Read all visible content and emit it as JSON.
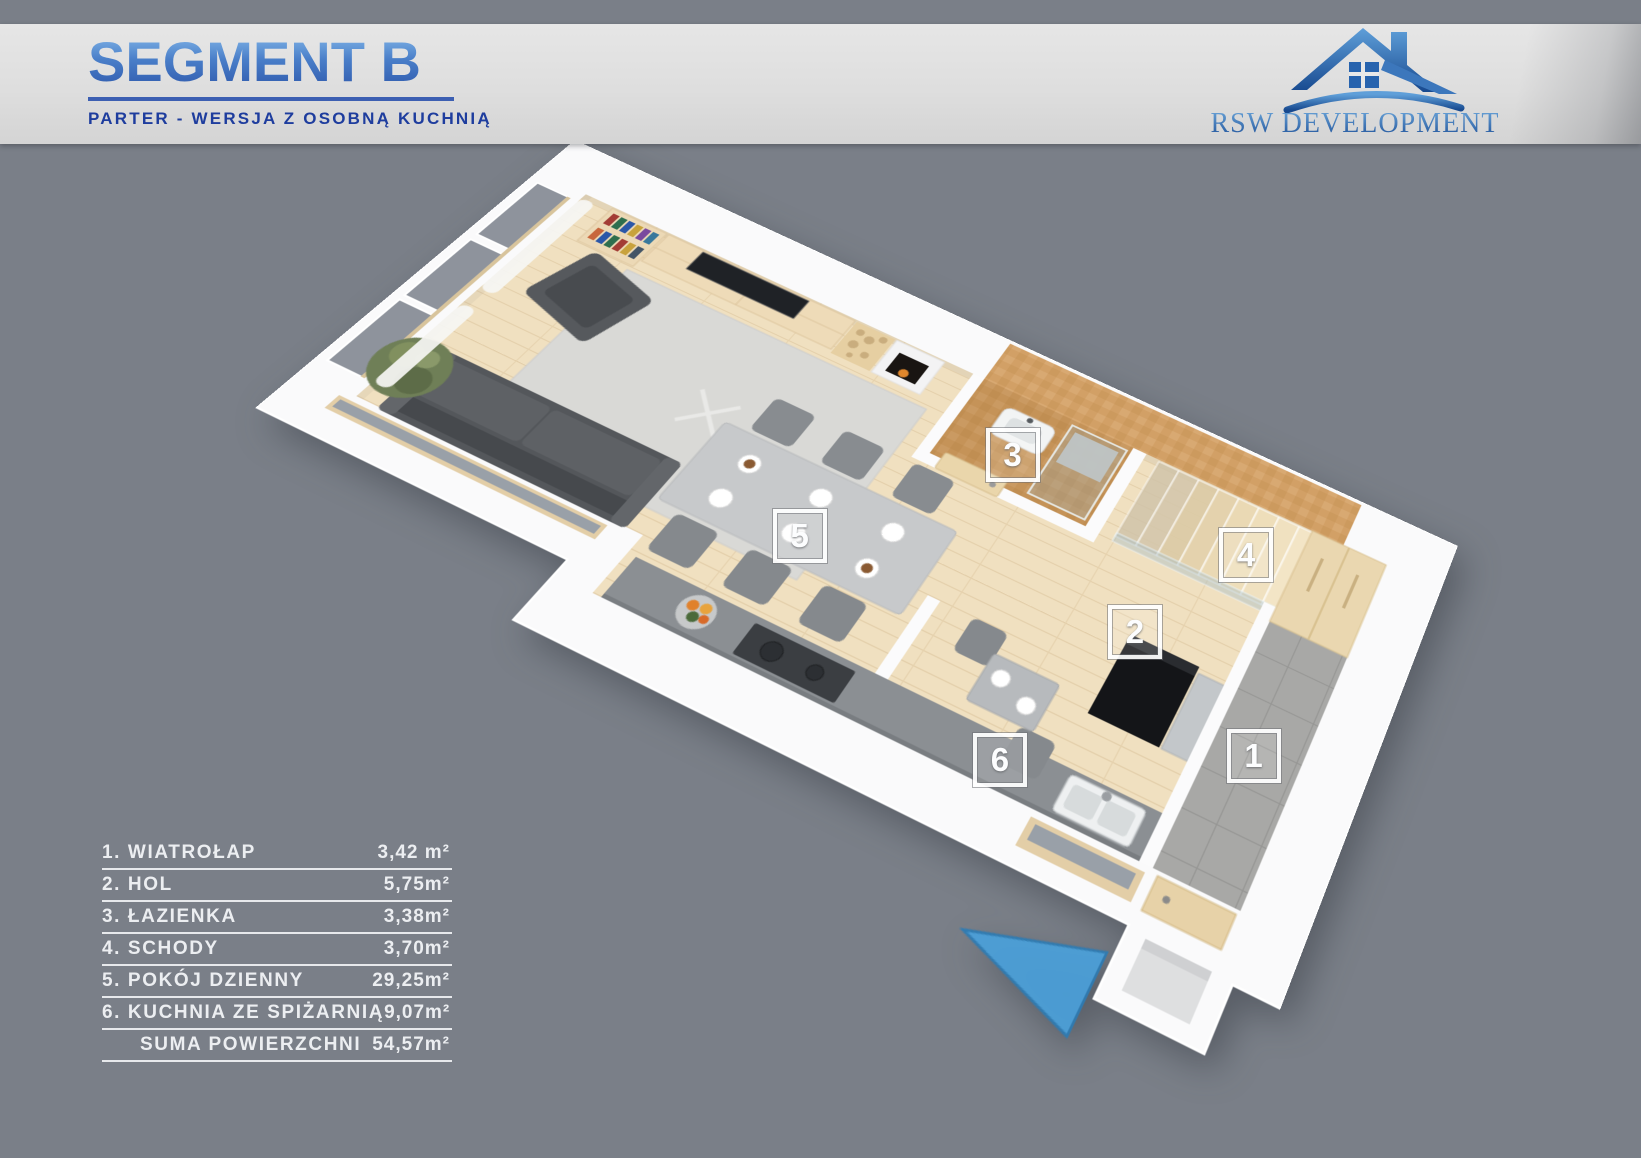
{
  "header": {
    "title": "SEGMENT B",
    "subtitle": "PARTER - WERSJA Z OSOBNĄ KUCHNIĄ"
  },
  "logo": {
    "name": "RSW DEVELOPMENT"
  },
  "plan": {
    "markers": [
      {
        "number": "1"
      },
      {
        "number": "2"
      },
      {
        "number": "3"
      },
      {
        "number": "4"
      },
      {
        "number": "5"
      },
      {
        "number": "6"
      }
    ],
    "entrance_arrow": "left"
  },
  "legend": {
    "rows": [
      {
        "label": "1. WIATROŁAP",
        "area": "3,42 m²"
      },
      {
        "label": "2. HOL",
        "area": "5,75m²"
      },
      {
        "label": "3. ŁAZIENKA",
        "area": "3,38m²"
      },
      {
        "label": "4. SCHODY",
        "area": "3,70m²"
      },
      {
        "label": "5. POKÓJ DZIENNY",
        "area": "29,25m²"
      },
      {
        "label": "6. KUCHNIA ZE SPIŻARNIĄ",
        "area": "9,07m²"
      },
      {
        "label": "SUMA POWIERZCHNI",
        "area": "54,57m²",
        "is_total": true
      }
    ]
  },
  "colors": {
    "background_gray": "#7a7f88",
    "band_gray": "#dedede",
    "title_blue": "#2d57ab",
    "subtitle_blue": "#1e3d9e",
    "logo_blue": "#2e6cb5",
    "arrow_blue": "#4ba0d9",
    "legend_text": "#eceef1",
    "wood_floor": "#f0e0c0",
    "bath_tile": "#d2a066"
  }
}
